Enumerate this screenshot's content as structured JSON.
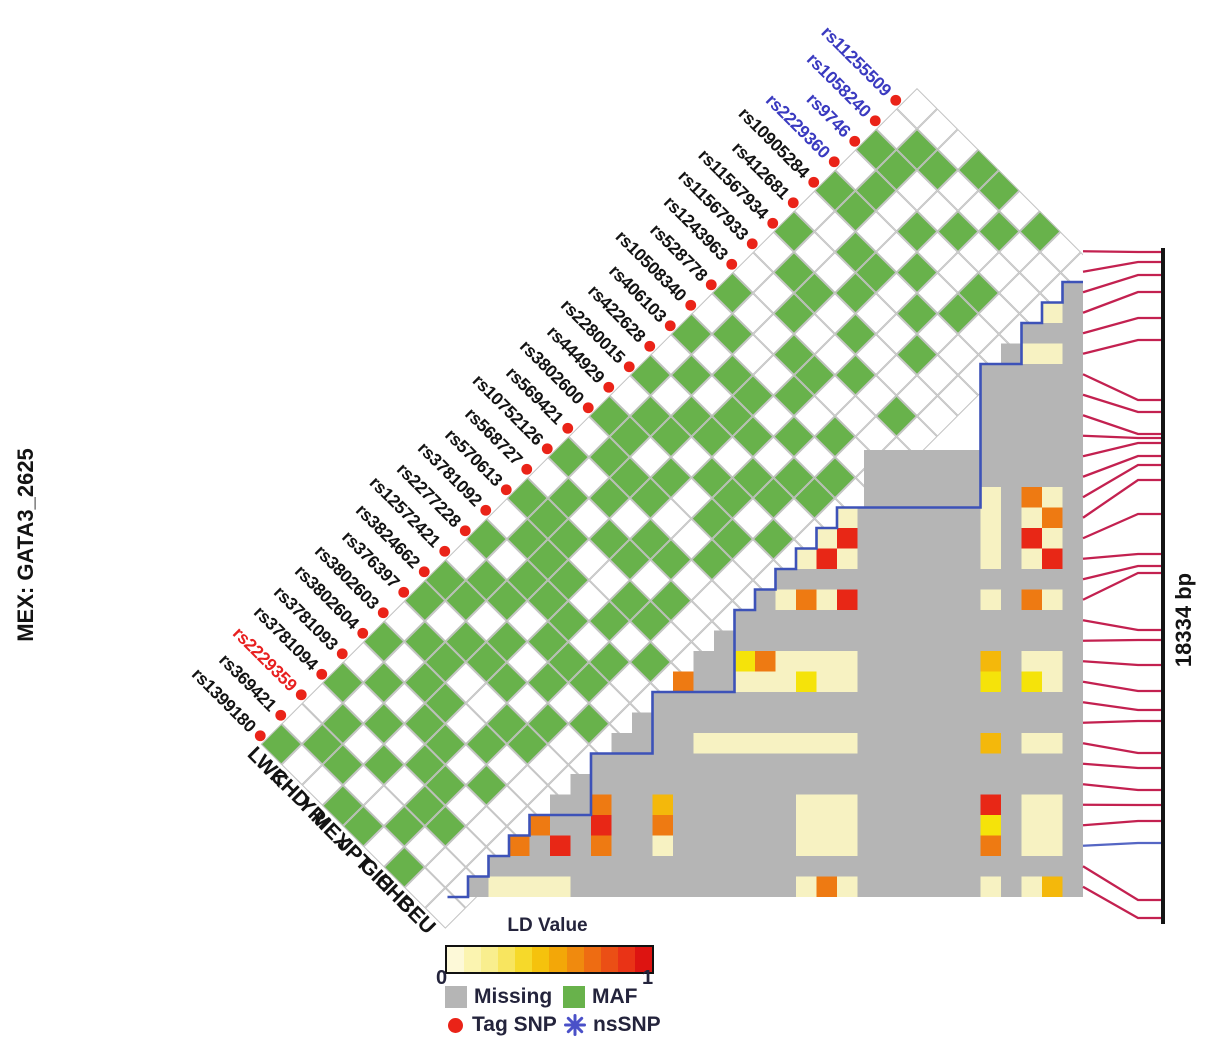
{
  "title": {
    "left_label": "MEX: GATA3_2625"
  },
  "scale": {
    "region_size_label": "18334 bp"
  },
  "legend": {
    "ld_title": "LD Value",
    "scale_min": "0",
    "scale_max": "1",
    "missing_label": "Missing",
    "maf_label": "MAF",
    "tag_snp_label": "Tag SNP",
    "nssnp_label": "nsSNP",
    "colorbar": [
      "#fdf9d8",
      "#fbf4b0",
      "#f9ee8e",
      "#f8e55f",
      "#f6d92a",
      "#f5c20d",
      "#f3a708",
      "#f08a0e",
      "#ee6c12",
      "#eb4f15",
      "#e93316",
      "#dd1411"
    ]
  },
  "chart_data": {
    "type": "heatmap",
    "title": "MEX: GATA3_2625",
    "region_size_bp": 18334,
    "populations": [
      "LWK",
      "CHD",
      "YRI",
      "MEX",
      "JPT",
      "GIH",
      "CHB",
      "CEU"
    ],
    "snps": [
      "rs11255509",
      "rs1058240",
      "rs9746",
      "rs2229360",
      "rs10905284",
      "rs412681",
      "rs11567934",
      "rs11567933",
      "rs1243963",
      "rs528778",
      "rs10508340",
      "rs406103",
      "rs422628",
      "rs2280015",
      "rs444929",
      "rs3802600",
      "rs569421",
      "rs10752126",
      "rs568727",
      "rs570613",
      "rs3781092",
      "rs2277228",
      "rs12572421",
      "rs3824662",
      "rs376397",
      "rs3802603",
      "rs3802604",
      "rs3781093",
      "rs3781094",
      "rs2229359",
      "rs369421",
      "rs1399180"
    ],
    "snp_label_colors": [
      "blue",
      "blue",
      "blue",
      "blue",
      "black",
      "black",
      "black",
      "black",
      "black",
      "black",
      "black",
      "black",
      "black",
      "black",
      "black",
      "black",
      "black",
      "black",
      "black",
      "black",
      "black",
      "black",
      "black",
      "black",
      "black",
      "black",
      "black",
      "black",
      "black",
      "red",
      "black",
      "black"
    ],
    "tag_snp": [
      true,
      true,
      true,
      true,
      true,
      true,
      true,
      true,
      true,
      true,
      true,
      true,
      true,
      true,
      true,
      true,
      true,
      true,
      true,
      true,
      true,
      true,
      true,
      true,
      true,
      true,
      true,
      true,
      true,
      true,
      true,
      true
    ],
    "maf": [
      "00011010",
      "01100100",
      "11001000",
      "01010010",
      "11001010",
      "00110100",
      "10010010",
      "01101000",
      "00100101",
      "10011000",
      "01001010",
      "10110101",
      "01011011",
      "10110110",
      "01101101",
      "11010110",
      "01110010",
      "10101100",
      "01011010",
      "11100110",
      "01110101",
      "10111010",
      "01101110",
      "11010101",
      "10111010",
      "01100110",
      "10110100",
      "01011010",
      "10101100",
      "01010110",
      "01100100",
      "10011010"
    ],
    "ld_palette": {
      "p": "#f7f2c2",
      "y": "#f5e30a",
      "g": "#f4b80b",
      "o": "#ee7a12",
      "r": "#e82716"
    },
    "ld_cells": [
      [
        2,
        4,
        "p"
      ],
      [
        2,
        6,
        "p"
      ],
      [
        3,
        6,
        "p"
      ],
      [
        12,
        14,
        "p"
      ],
      [
        13,
        15,
        "p"
      ],
      [
        12,
        15,
        "r"
      ],
      [
        14,
        16,
        "p"
      ],
      [
        13,
        16,
        "r"
      ],
      [
        12,
        16,
        "p"
      ],
      [
        5,
        13,
        "p"
      ],
      [
        5,
        14,
        "p"
      ],
      [
        5,
        15,
        "p"
      ],
      [
        5,
        16,
        "p"
      ],
      [
        3,
        13,
        "o"
      ],
      [
        2,
        13,
        "p"
      ],
      [
        3,
        14,
        "p"
      ],
      [
        2,
        14,
        "o"
      ],
      [
        3,
        15,
        "r"
      ],
      [
        2,
        15,
        "p"
      ],
      [
        3,
        16,
        "p"
      ],
      [
        2,
        16,
        "r"
      ],
      [
        15,
        18,
        "p"
      ],
      [
        14,
        18,
        "o"
      ],
      [
        13,
        18,
        "p"
      ],
      [
        12,
        18,
        "r"
      ],
      [
        5,
        18,
        "p"
      ],
      [
        3,
        18,
        "o"
      ],
      [
        2,
        18,
        "p"
      ],
      [
        17,
        21,
        "y"
      ],
      [
        16,
        21,
        "o"
      ],
      [
        15,
        21,
        "p"
      ],
      [
        14,
        21,
        "p"
      ],
      [
        13,
        21,
        "p"
      ],
      [
        12,
        21,
        "p"
      ],
      [
        20,
        22,
        "o"
      ],
      [
        17,
        22,
        "p"
      ],
      [
        16,
        22,
        "p"
      ],
      [
        15,
        22,
        "p"
      ],
      [
        14,
        22,
        "y"
      ],
      [
        13,
        22,
        "p"
      ],
      [
        12,
        22,
        "p"
      ],
      [
        5,
        21,
        "g"
      ],
      [
        5,
        22,
        "y"
      ],
      [
        3,
        21,
        "p"
      ],
      [
        2,
        21,
        "p"
      ],
      [
        3,
        22,
        "y"
      ],
      [
        2,
        22,
        "p"
      ],
      [
        19,
        25,
        "p"
      ],
      [
        18,
        25,
        "p"
      ],
      [
        17,
        25,
        "p"
      ],
      [
        16,
        25,
        "p"
      ],
      [
        15,
        25,
        "p"
      ],
      [
        14,
        25,
        "p"
      ],
      [
        13,
        25,
        "p"
      ],
      [
        12,
        25,
        "p"
      ],
      [
        5,
        25,
        "g"
      ],
      [
        3,
        25,
        "p"
      ],
      [
        2,
        25,
        "p"
      ],
      [
        24,
        28,
        "o"
      ],
      [
        24,
        29,
        "r"
      ],
      [
        24,
        30,
        "o"
      ],
      [
        27,
        29,
        "o"
      ],
      [
        26,
        30,
        "r"
      ],
      [
        28,
        30,
        "o"
      ],
      [
        21,
        28,
        "g"
      ],
      [
        21,
        29,
        "o"
      ],
      [
        21,
        30,
        "p"
      ],
      [
        14,
        28,
        "p"
      ],
      [
        13,
        28,
        "p"
      ],
      [
        12,
        28,
        "p"
      ],
      [
        14,
        29,
        "p"
      ],
      [
        13,
        29,
        "p"
      ],
      [
        12,
        29,
        "p"
      ],
      [
        14,
        30,
        "p"
      ],
      [
        13,
        30,
        "p"
      ],
      [
        12,
        30,
        "p"
      ],
      [
        5,
        28,
        "r"
      ],
      [
        5,
        29,
        "y"
      ],
      [
        5,
        30,
        "o"
      ],
      [
        3,
        28,
        "p"
      ],
      [
        2,
        28,
        "p"
      ],
      [
        3,
        29,
        "p"
      ],
      [
        2,
        29,
        "p"
      ],
      [
        3,
        30,
        "p"
      ],
      [
        2,
        30,
        "p"
      ],
      [
        29,
        32,
        "p"
      ],
      [
        28,
        32,
        "p"
      ],
      [
        27,
        32,
        "p"
      ],
      [
        26,
        32,
        "p"
      ],
      [
        14,
        32,
        "p"
      ],
      [
        13,
        32,
        "o"
      ],
      [
        12,
        32,
        "p"
      ],
      [
        5,
        32,
        "p"
      ],
      [
        3,
        32,
        "p"
      ],
      [
        2,
        32,
        "g"
      ]
    ],
    "map_positions": [
      252,
      262,
      275,
      292,
      318,
      340,
      400,
      412,
      434,
      438,
      443,
      456,
      465,
      480,
      514,
      554,
      566,
      573,
      630,
      640,
      665,
      691,
      710,
      721,
      753,
      768,
      790,
      805,
      821,
      843,
      900,
      918
    ],
    "blue_map_line_index": 30,
    "colors": {
      "maf_green": "#68b24b",
      "missing_gray": "#b5b5b5",
      "boundary_blue": "#3d52b8",
      "map_line_red": "#c32150",
      "map_line_blue": "#5566c4",
      "tag_dot_red": "#ea2318",
      "label_blue": "#3a3ac0",
      "label_red": "#e82020",
      "label_black": "#131313",
      "scale_bar_black": "#141414"
    }
  }
}
